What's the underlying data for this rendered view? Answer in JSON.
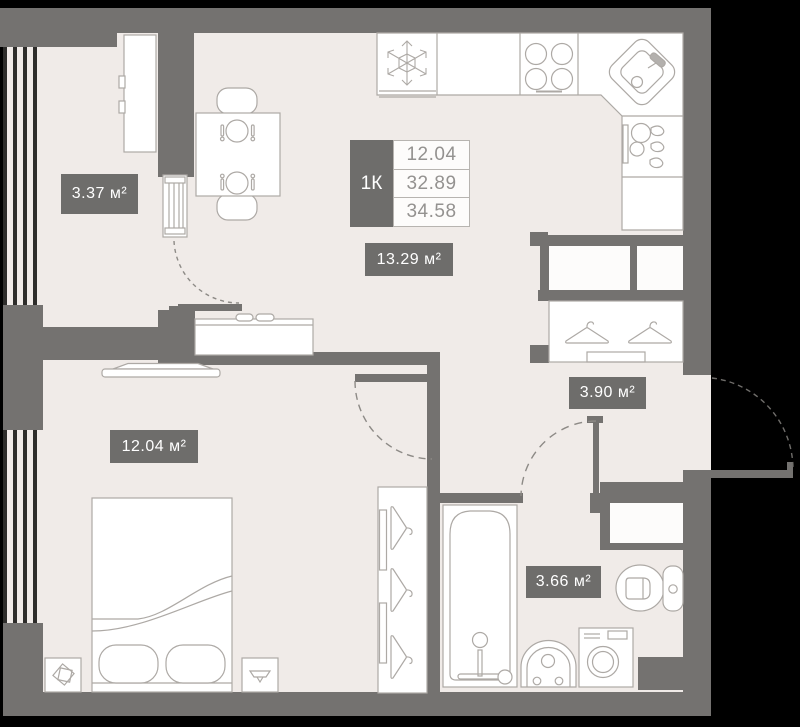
{
  "plan": {
    "title": "1-room apartment floor plan",
    "unit_summary": {
      "type_label": "1К",
      "area_rows": [
        "12.04",
        "32.89",
        "34.58"
      ]
    },
    "rooms": {
      "balcony": {
        "area_label": "3.37 м²"
      },
      "kitchen_living": {
        "area_label": "13.29 м²"
      },
      "bedroom": {
        "area_label": "12.04 м²"
      },
      "hallway": {
        "area_label": "3.90 м²"
      },
      "bathroom": {
        "area_label": "3.66 м²"
      }
    },
    "icons": {
      "fridge": "snowflake-icon",
      "stove": "four-burners-icon",
      "kitchen_sink": "corner-sink-icon",
      "dishwasher": "dishwasher-icon",
      "closet": "hanger-icon",
      "bathtub": "bathtub-icon",
      "wash_basin": "pedestal-sink-icon",
      "washing_machine": "washing-machine-icon",
      "toilet": "toilet-icon",
      "dining": "place-setting-icon",
      "heating": "radiator-icon"
    },
    "colors": {
      "background": "#000000",
      "floor": "#f0ebe8",
      "wall": "#747270",
      "badge": "#6e6d6b",
      "furniture_outline": "#ada9a5",
      "door_arc": "#8d8a86",
      "value_text": "#949290"
    }
  }
}
